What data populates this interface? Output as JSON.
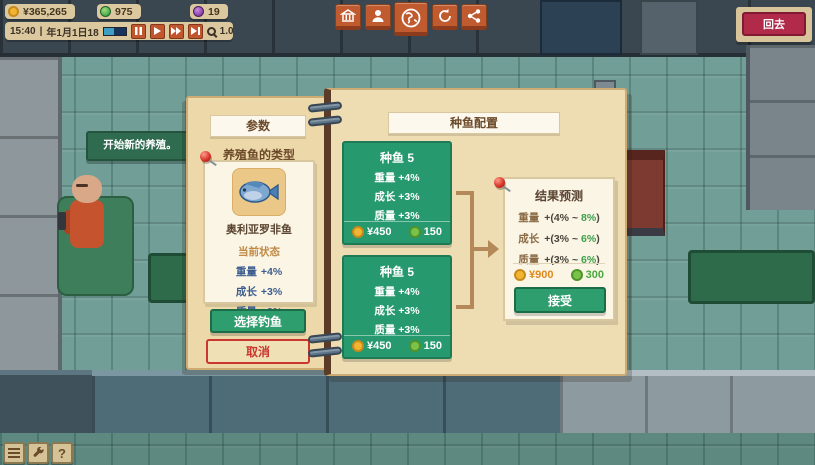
{
  "hud": {
    "money": "¥365,265",
    "resource_green": "975",
    "resource_purple": "19",
    "time": "15:40",
    "separator": "|",
    "date": "年1月1日18",
    "zoom_level": "1.0x",
    "playback_icons": [
      "pause-icon",
      "play-icon",
      "fast-forward-icon",
      "fastest-icon"
    ]
  },
  "toolbar": {
    "icons": [
      "building-icon",
      "character-icon",
      "world-icon",
      "cycle-icon",
      "network-icon"
    ]
  },
  "back_button": {
    "label": "回去"
  },
  "speech_bubble": {
    "text": "开始新的养殖。"
  },
  "params_panel": {
    "header": "参数",
    "section_title": "养殖鱼的类型",
    "fish_card": {
      "name": "奥利亚罗非鱼",
      "status_label": "当前状态",
      "stats": [
        {
          "label": "重量",
          "value": "+4%"
        },
        {
          "label": "成长",
          "value": "+3%"
        },
        {
          "label": "质量",
          "value": "+3%"
        }
      ]
    },
    "select_fish_button": "选择钓鱼",
    "cancel_button": "取消"
  },
  "config_panel": {
    "header": "种鱼配置",
    "broodfish_cards": [
      {
        "title": "种鱼 5",
        "stats": [
          {
            "label": "重量",
            "value": "+4%"
          },
          {
            "label": "成长",
            "value": "+3%"
          },
          {
            "label": "质量",
            "value": "+3%"
          }
        ],
        "gold_cost": "¥450",
        "green_cost": "150"
      },
      {
        "title": "种鱼 5",
        "stats": [
          {
            "label": "重量",
            "value": "+4%"
          },
          {
            "label": "成长",
            "value": "+3%"
          },
          {
            "label": "质量",
            "value": "+3%"
          }
        ],
        "gold_cost": "¥450",
        "green_cost": "150"
      }
    ],
    "result_card": {
      "header": "结果预测",
      "stats": [
        {
          "label": "重量",
          "mid": "+(4% ~",
          "max": "8%",
          "close": ")"
        },
        {
          "label": "成长",
          "mid": "+(3% ~",
          "max": "6%",
          "close": ")"
        },
        {
          "label": "质量",
          "mid": "+(3% ~",
          "max": "6%",
          "close": ")"
        }
      ],
      "gold_cost": "¥900",
      "green_cost": "300",
      "accept_button": "接受"
    }
  },
  "tools": {
    "help_label": "?",
    "icons": [
      "menu-icon",
      "wrench-icon",
      "help-icon"
    ]
  },
  "colors": {
    "panel_tan": "#eedcb2",
    "card_green": "#27996e",
    "button_green": "#2f9e6f",
    "cancel_red": "#c9372e",
    "hud_tan": "#dbc89e",
    "action_orange": "#c05a2f",
    "back_red": "#b12a4a",
    "stat_blue": "#3c5d8e",
    "range_green": "#3aa048",
    "gold": "#f2b431"
  }
}
